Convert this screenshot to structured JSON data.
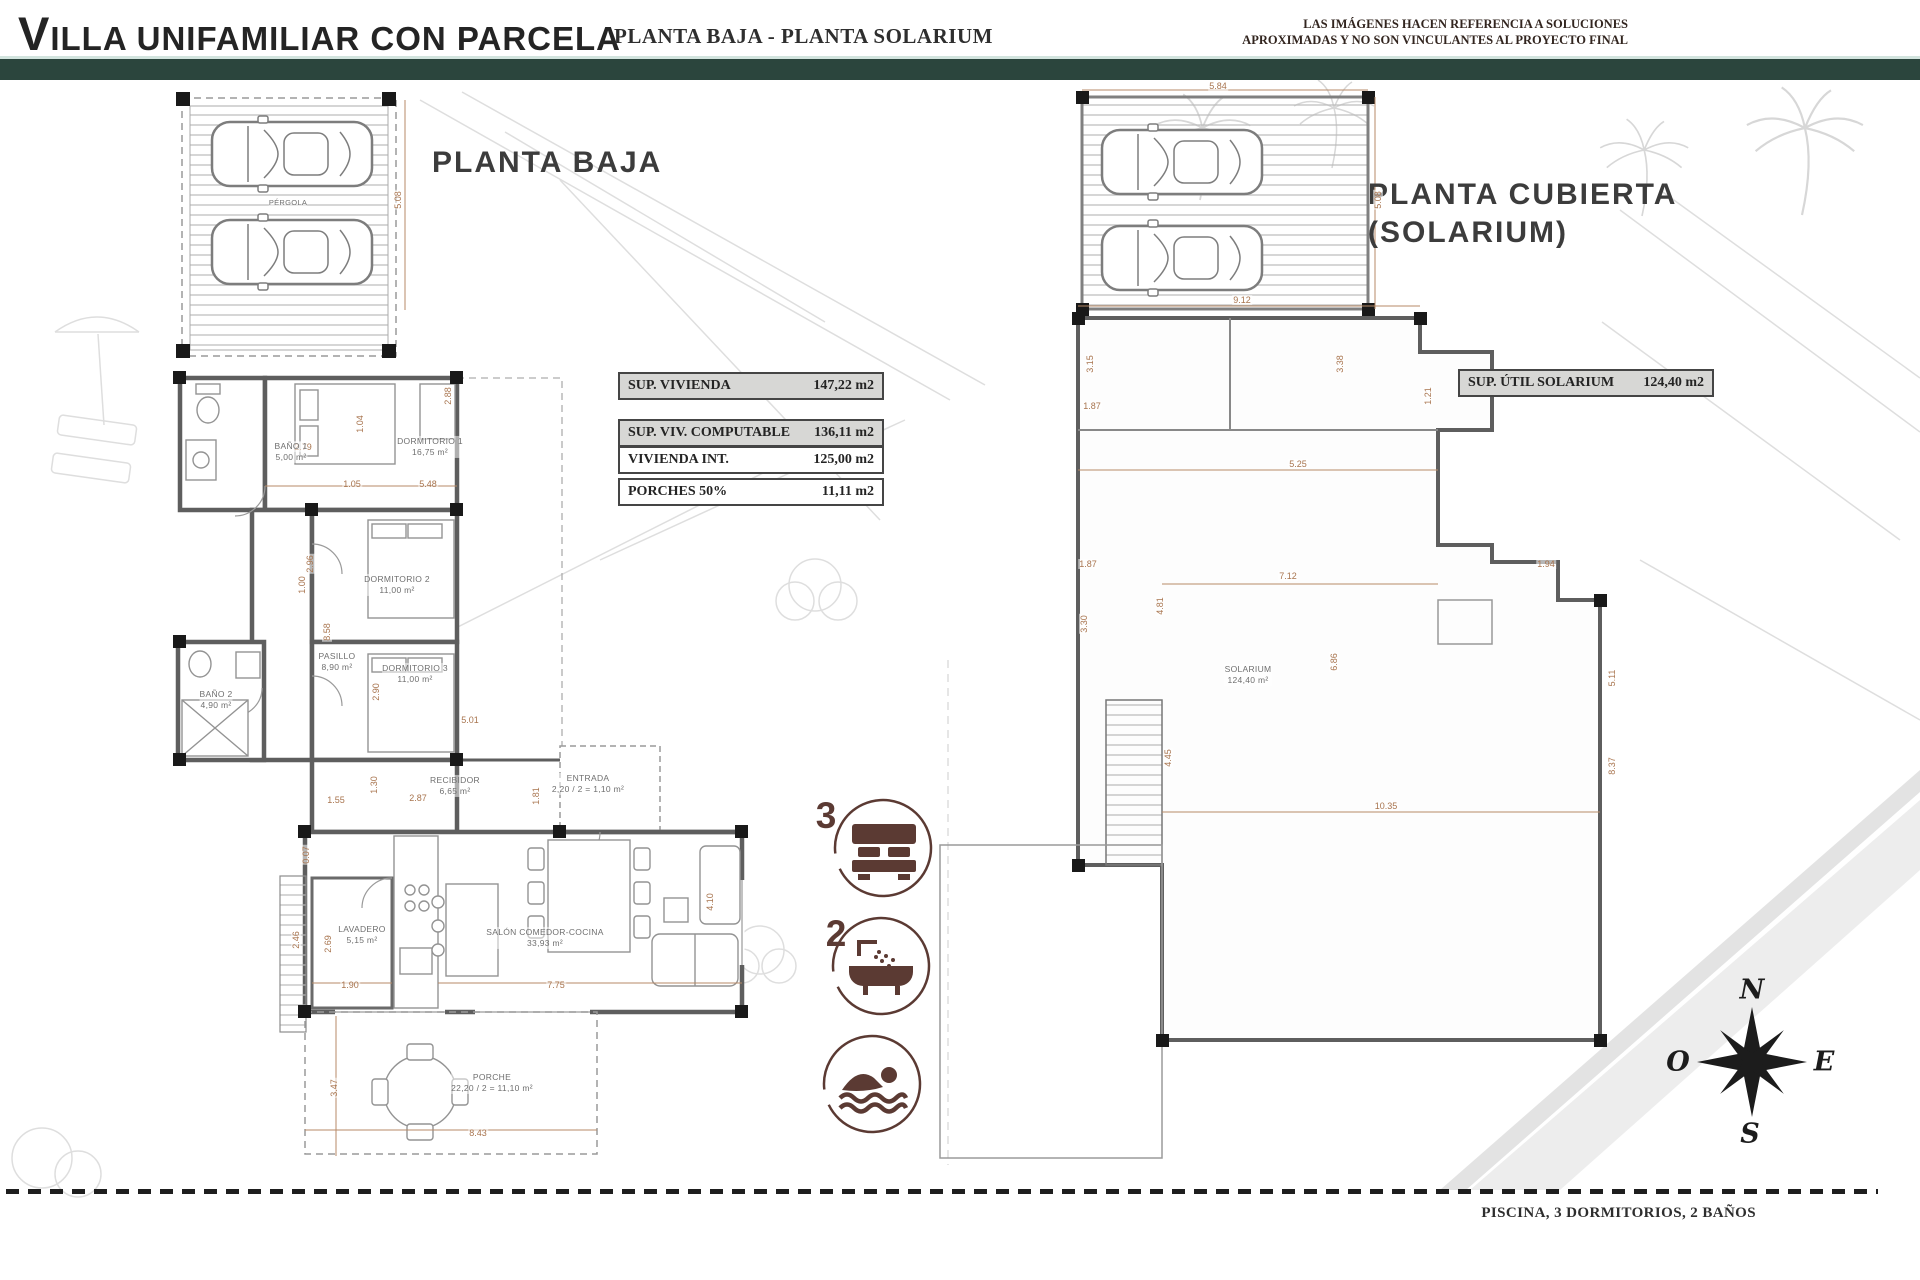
{
  "header": {
    "title": "VILLA UNIFAMILIAR CON PARCELA",
    "subtitle": "PLANTA BAJA - PLANTA SOLARIUM",
    "disclaimer_line1": "LAS IMÁGENES HACEN REFERENCIA A SOLUCIONES",
    "disclaimer_line2": "APROXIMADAS Y NO SON VINCULANTES AL PROYECTO FINAL"
  },
  "planta_baja": {
    "title": "PLANTA BAJA",
    "area_table": {
      "rows": [
        {
          "label": "SUP. VIVIENDA",
          "value": "147,22 m2"
        },
        {
          "label": "SUP. VIV. COMPUTABLE",
          "value": "136,11 m2"
        },
        {
          "label": "VIVIENDA INT.",
          "value": "125,00 m2"
        },
        {
          "label": "PORCHES 50%",
          "value": "11,11 m2"
        }
      ]
    },
    "rooms": [
      {
        "name": "PÉRGOLA",
        "area": ""
      },
      {
        "name": "BAÑO 1",
        "area": "5,00 m²"
      },
      {
        "name": "DORMITORIO 1",
        "area": "16,75 m²"
      },
      {
        "name": "DORMITORIO 2",
        "area": "11,00 m²"
      },
      {
        "name": "DORMITORIO 3",
        "area": "11,00 m²"
      },
      {
        "name": "PASILLO",
        "area": "8,90 m²"
      },
      {
        "name": "BAÑO 2",
        "area": "4,90 m²"
      },
      {
        "name": "RECIBIDOR",
        "area": "6,65 m²"
      },
      {
        "name": "ENTRADA",
        "area": "2,20 / 2 = 1,10 m²"
      },
      {
        "name": "LAVADERO",
        "area": "5,15 m²"
      },
      {
        "name": "SALÓN COMEDOR-COCINA",
        "area": "33,93 m²"
      },
      {
        "name": "PORCHE",
        "area": "22,20 / 2 = 11,10 m²"
      }
    ],
    "dimensions": [
      "5.08",
      "2.79",
      "1.04",
      "1.05",
      "5.48",
      "2.88",
      "2.96",
      "8.58",
      "1.00",
      "2.90",
      "5.01",
      "1.30",
      "2.87",
      "1.55",
      "1.81",
      "0.07",
      "2.69",
      "1.90",
      "7.75",
      "4.10",
      "2.46",
      "3.47",
      "8.43"
    ]
  },
  "planta_solarium": {
    "title_line1": "PLANTA CUBIERTA",
    "title_line2": "(SOLARIUM)",
    "area_box": {
      "label": "SUP. ÚTIL SOLARIUM",
      "value": "124,40 m2"
    },
    "room": {
      "name": "SOLARIUM",
      "area": "124,40 m²"
    },
    "dimensions": [
      "5.84",
      "5.08",
      "9.12",
      "3.15",
      "3.38",
      "1.87",
      "1.21",
      "5.25",
      "4.81",
      "6.86",
      "1.87",
      "1.94",
      "7.12",
      "3.30",
      "5.11",
      "8.37",
      "4.45",
      "10.35"
    ]
  },
  "features": [
    {
      "count": "3",
      "name": "bedrooms",
      "icon": "bed-icon"
    },
    {
      "count": "2",
      "name": "bathrooms",
      "icon": "bathtub-icon"
    },
    {
      "count": "",
      "name": "pool",
      "icon": "swimmer-icon"
    }
  ],
  "compass": {
    "north": "N",
    "east": "E",
    "south": "S",
    "west": "O"
  },
  "footer": {
    "text": "PISCINA, 3 DORMITORIOS, 2 BAÑOS"
  },
  "colors": {
    "accent_green": "#2b453d",
    "icon_color": "#5b3a33",
    "dimension_color": "#a8744e",
    "table_shade": "#d7d7d5"
  }
}
